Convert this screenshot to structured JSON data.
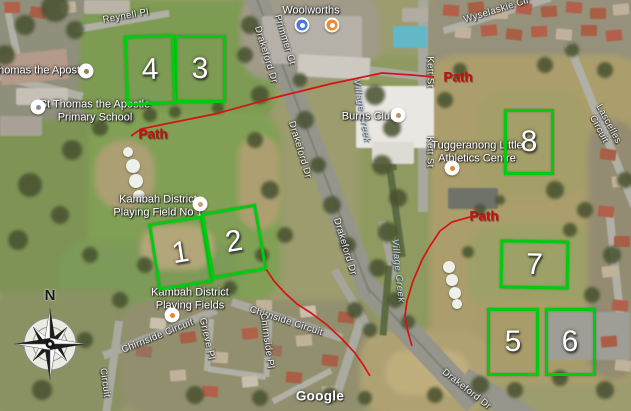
{
  "map": {
    "attribution": "Google",
    "compass": {
      "north_label": "N"
    },
    "fields": [
      {
        "number": "1",
        "x": 177,
        "y": 250,
        "w": 49,
        "h": 62,
        "rot": -9
      },
      {
        "number": "2",
        "x": 231,
        "y": 238,
        "w": 50,
        "h": 61,
        "rot": -10
      },
      {
        "number": "3",
        "x": 197,
        "y": 66,
        "w": 46,
        "h": 62,
        "rot": 0
      },
      {
        "number": "4",
        "x": 147,
        "y": 67,
        "w": 44,
        "h": 64,
        "rot": -2
      },
      {
        "number": "5",
        "x": 510,
        "y": 339,
        "w": 46,
        "h": 62,
        "rot": 0
      },
      {
        "number": "6",
        "x": 567,
        "y": 339,
        "w": 45,
        "h": 62,
        "rot": 0
      },
      {
        "number": "7",
        "x": 531,
        "y": 261,
        "w": 63,
        "h": 43,
        "rot": 1
      },
      {
        "number": "8",
        "x": 526,
        "y": 139,
        "w": 44,
        "h": 60,
        "rot": 0
      }
    ],
    "paths": [
      {
        "name": "path-west",
        "points": "131,136 141,129 170,123 215,114 273,98 330,84 382,73 412,75 434,77"
      },
      {
        "name": "path-east",
        "points": "470,217 452,222 440,231 430,246 422,260 413,281 407,301 405,316 408,332 412,346"
      },
      {
        "name": "path-south",
        "points": "266,269 274,281 285,293 297,304 311,313 327,325 342,339 355,353 364,366 370,376"
      }
    ],
    "path_labels": [
      {
        "text": "Path",
        "x": 153,
        "y": 134
      },
      {
        "text": "Path",
        "x": 458,
        "y": 77
      },
      {
        "text": "Path",
        "x": 484,
        "y": 216
      }
    ],
    "road_labels": [
      {
        "text": "Reynell Pl",
        "x": 126,
        "y": 17,
        "rot": -10
      },
      {
        "text": "Primmer Ct",
        "x": 284,
        "y": 40,
        "rot": 73
      },
      {
        "text": "Drakeford Dr",
        "x": 265,
        "y": 55,
        "rot": 73
      },
      {
        "text": "Drakeford Dr",
        "x": 299,
        "y": 150,
        "rot": 73
      },
      {
        "text": "Drakeford Dr",
        "x": 344,
        "y": 247,
        "rot": 73
      },
      {
        "text": "Drakeford Dr",
        "x": 466,
        "y": 390,
        "rot": 38
      },
      {
        "text": "Kett St",
        "x": 429,
        "y": 72,
        "rot": 90
      },
      {
        "text": "Kett St",
        "x": 429,
        "y": 152,
        "rot": 90
      },
      {
        "text": "Wyselaskie Cir",
        "x": 497,
        "y": 11,
        "rot": -17
      },
      {
        "text": "Lascelles Circuit",
        "x": 603,
        "y": 127,
        "rot": 62
      },
      {
        "text": "Chirnside Circuit",
        "x": 158,
        "y": 337,
        "rot": -22
      },
      {
        "text": "Chirnside Circuit",
        "x": 286,
        "y": 322,
        "rot": 18
      },
      {
        "text": "Chirnside Pl",
        "x": 266,
        "y": 341,
        "rot": 82
      },
      {
        "text": "Grieve Pl",
        "x": 206,
        "y": 339,
        "rot": 77
      },
      {
        "text": "Circuit",
        "x": 104,
        "y": 383,
        "rot": 82
      }
    ],
    "poi_labels": [
      {
        "text": "Woolworths",
        "x": 311,
        "y": 11
      },
      {
        "text": "Burns Club",
        "x": 369,
        "y": 117
      },
      {
        "text": "Tuggeranong Little\nAthletics Centre",
        "x": 477,
        "y": 152
      },
      {
        "text": "St Thomas the Apostle\nPrimary School",
        "x": 95,
        "y": 111
      },
      {
        "text": "Thomas the Apostle",
        "x": 40,
        "y": 71
      },
      {
        "text": "Kambah District\nPlaying Field No 1",
        "x": 158,
        "y": 206
      },
      {
        "text": "Kambah District\nPlaying Fields",
        "x": 190,
        "y": 299
      }
    ],
    "water_labels": [
      {
        "text": "Village Creek",
        "x": 361,
        "y": 111,
        "rot": 80
      },
      {
        "text": "Village Creek",
        "x": 397,
        "y": 271,
        "rot": 84
      }
    ],
    "poi_icons": [
      {
        "name": "shopping-cart-icon",
        "x": 302,
        "y": 25,
        "bg": "#4a78dc",
        "dot": "#ffffff"
      },
      {
        "name": "restaurant-icon",
        "x": 332,
        "y": 25,
        "bg": "#ee8b30",
        "dot": "#ffffff"
      },
      {
        "name": "burns-club-icon",
        "x": 398,
        "y": 115,
        "bg": "#ffffff",
        "dot": "#b5936b"
      },
      {
        "name": "athletics-centre-icon",
        "x": 452,
        "y": 168,
        "bg": "#ffffff",
        "dot": "#e8842c"
      },
      {
        "name": "playing-field-icon",
        "x": 200,
        "y": 204,
        "bg": "#ffffff",
        "dot": "#c4a177"
      },
      {
        "name": "playing-fields-icon",
        "x": 172,
        "y": 315,
        "bg": "#ffffff",
        "dot": "#e8842c"
      },
      {
        "name": "school-icon",
        "x": 38,
        "y": 107,
        "bg": "#ffffff",
        "dot": "#8a8f94"
      },
      {
        "name": "church-icon",
        "x": 86,
        "y": 71,
        "bg": "#ffffff",
        "dot": "#9b7c52"
      }
    ]
  }
}
